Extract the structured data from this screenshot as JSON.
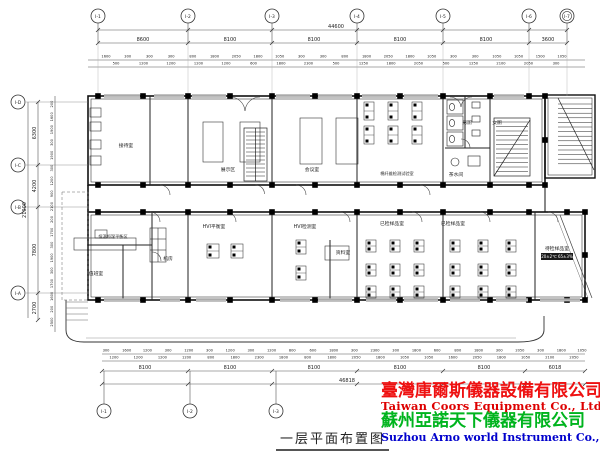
{
  "title": {
    "text": "一层平面布置图"
  },
  "company": {
    "line1_zh": "臺灣庫爾斯儀器設備有限公司",
    "line1_en": "Taiwan Coors Equipment Co., Ltd.",
    "line2_zh": "蘇州亞諾天下儀器有限公司",
    "line2_en": "Suzhou Arno world Instrument Co., Ltd.",
    "color_zh1": "#ee1111",
    "color_en1": "#dd0000",
    "color_zh2": "#00b41e",
    "color_en2": "#0000cc"
  },
  "grid": {
    "top_axes": [
      "I-1",
      "I-2",
      "I-3",
      "I-4",
      "I-5",
      "I-6",
      "I-7"
    ],
    "bottom_axes": [
      "I-1",
      "I-2",
      "I-3"
    ],
    "left_axes": [
      "I-D",
      "I-C",
      "I-B",
      "I-A"
    ]
  },
  "dimensions": {
    "top_overall": "44600",
    "top_segments": [
      "8600",
      "8100",
      "8100",
      "8100",
      "8100",
      "3600"
    ],
    "top_small_upper": [
      "1600",
      "300",
      "300",
      "300",
      "800",
      "1800",
      "2050",
      "1800",
      "1050",
      "300",
      "300",
      "800",
      "1800",
      "2050",
      "1800",
      "1050",
      "300",
      "300",
      "1050",
      "1050",
      "1500",
      "1050"
    ],
    "top_small_lower": [
      "500",
      "1200",
      "1200",
      "1200",
      "1200",
      "600",
      "1800",
      "2300",
      "500",
      "1250",
      "1800",
      "2050",
      "500",
      "1250",
      "2100",
      "2050",
      "300"
    ],
    "left_overall": "21000",
    "left_segments": [
      "6300",
      "4200",
      "7800",
      "2700"
    ],
    "left_small": [
      "200",
      "1600",
      "1900",
      "300",
      "1900",
      "300",
      "1200",
      "900",
      "2100",
      "200",
      "1700",
      "300",
      "1900",
      "300",
      "1700",
      "1600",
      "200",
      "2500"
    ],
    "bottom_small_upper": [
      "300",
      "1600",
      "1200",
      "300",
      "1200",
      "300",
      "1200",
      "300",
      "1200",
      "800",
      "600",
      "1800",
      "300",
      "2300",
      "300",
      "1800",
      "600",
      "800",
      "1800",
      "300",
      "2050",
      "300",
      "1800",
      "1050"
    ],
    "bottom_small_lower": [
      "1200",
      "1200",
      "1200",
      "1200",
      "800",
      "1800",
      "2300",
      "1800",
      "800",
      "1800",
      "2050",
      "1800",
      "1050",
      "1050",
      "1600",
      "2050",
      "1800",
      "1050",
      "2100",
      "2050"
    ],
    "bottom_segments": [
      "8100",
      "8100",
      "8100",
      "8100",
      "8100",
      "6018"
    ],
    "bottom_overall": "46818"
  },
  "rooms": [
    "接待室",
    "展示区",
    "会议室",
    "棉纤维检测试验室",
    "男厕",
    "女厕",
    "茶水间",
    "HVI平衡室",
    "HVI检测室",
    "已检样品室",
    "已检样品室",
    "待检样品室",
    "恒温恒湿平衡区",
    "值班室",
    "机房",
    "资料室"
  ],
  "annotations": {
    "sample_box": "20±2℃ 65±3%"
  }
}
